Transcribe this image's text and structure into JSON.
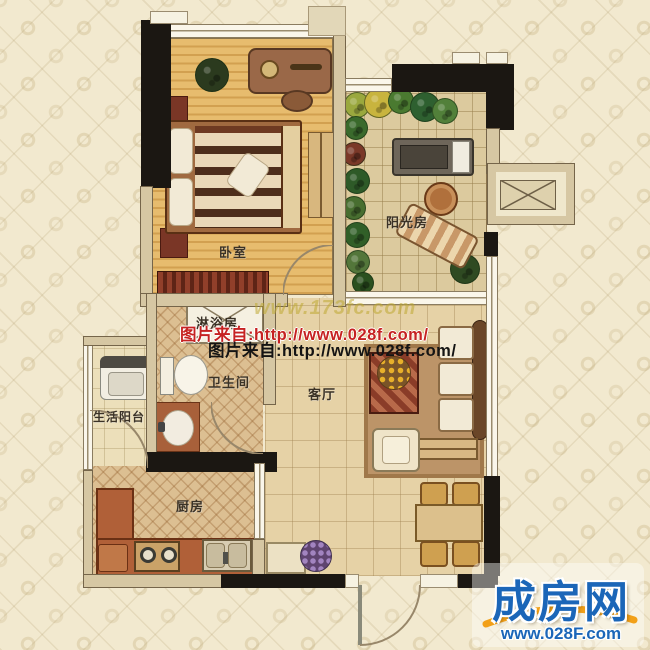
{
  "plan": {
    "rooms": {
      "bedroom": {
        "label": "卧室"
      },
      "sunroom": {
        "label": "阳光房"
      },
      "shower": {
        "label": "淋浴房"
      },
      "bathroom": {
        "label": "卫生间"
      },
      "service_balcony": {
        "label": "生活阳台"
      },
      "kitchen": {
        "label": "厨房"
      },
      "living_room": {
        "label": "客厅"
      }
    }
  },
  "watermarks": {
    "faint_site": "www.173fc.com",
    "line_red": "图片来自:http://www.028f.com/",
    "line_black": "图片来自:http://www.028f.com/"
  },
  "logo": {
    "name": "成房网",
    "url": "www.028F.com"
  },
  "colors": {
    "background": "#f2e9cf",
    "wall_black": "#1b1712",
    "wall_tan": "#d6c7a3",
    "bedroom_floor": "#e0b264",
    "tile_floor": "#e6d2a6",
    "counter": "#b06038",
    "logo_blue": "#1b66b8",
    "logo_orange": "#f2a018",
    "watermark_red": "#c62222",
    "watermark_yellow": "#baa832"
  }
}
